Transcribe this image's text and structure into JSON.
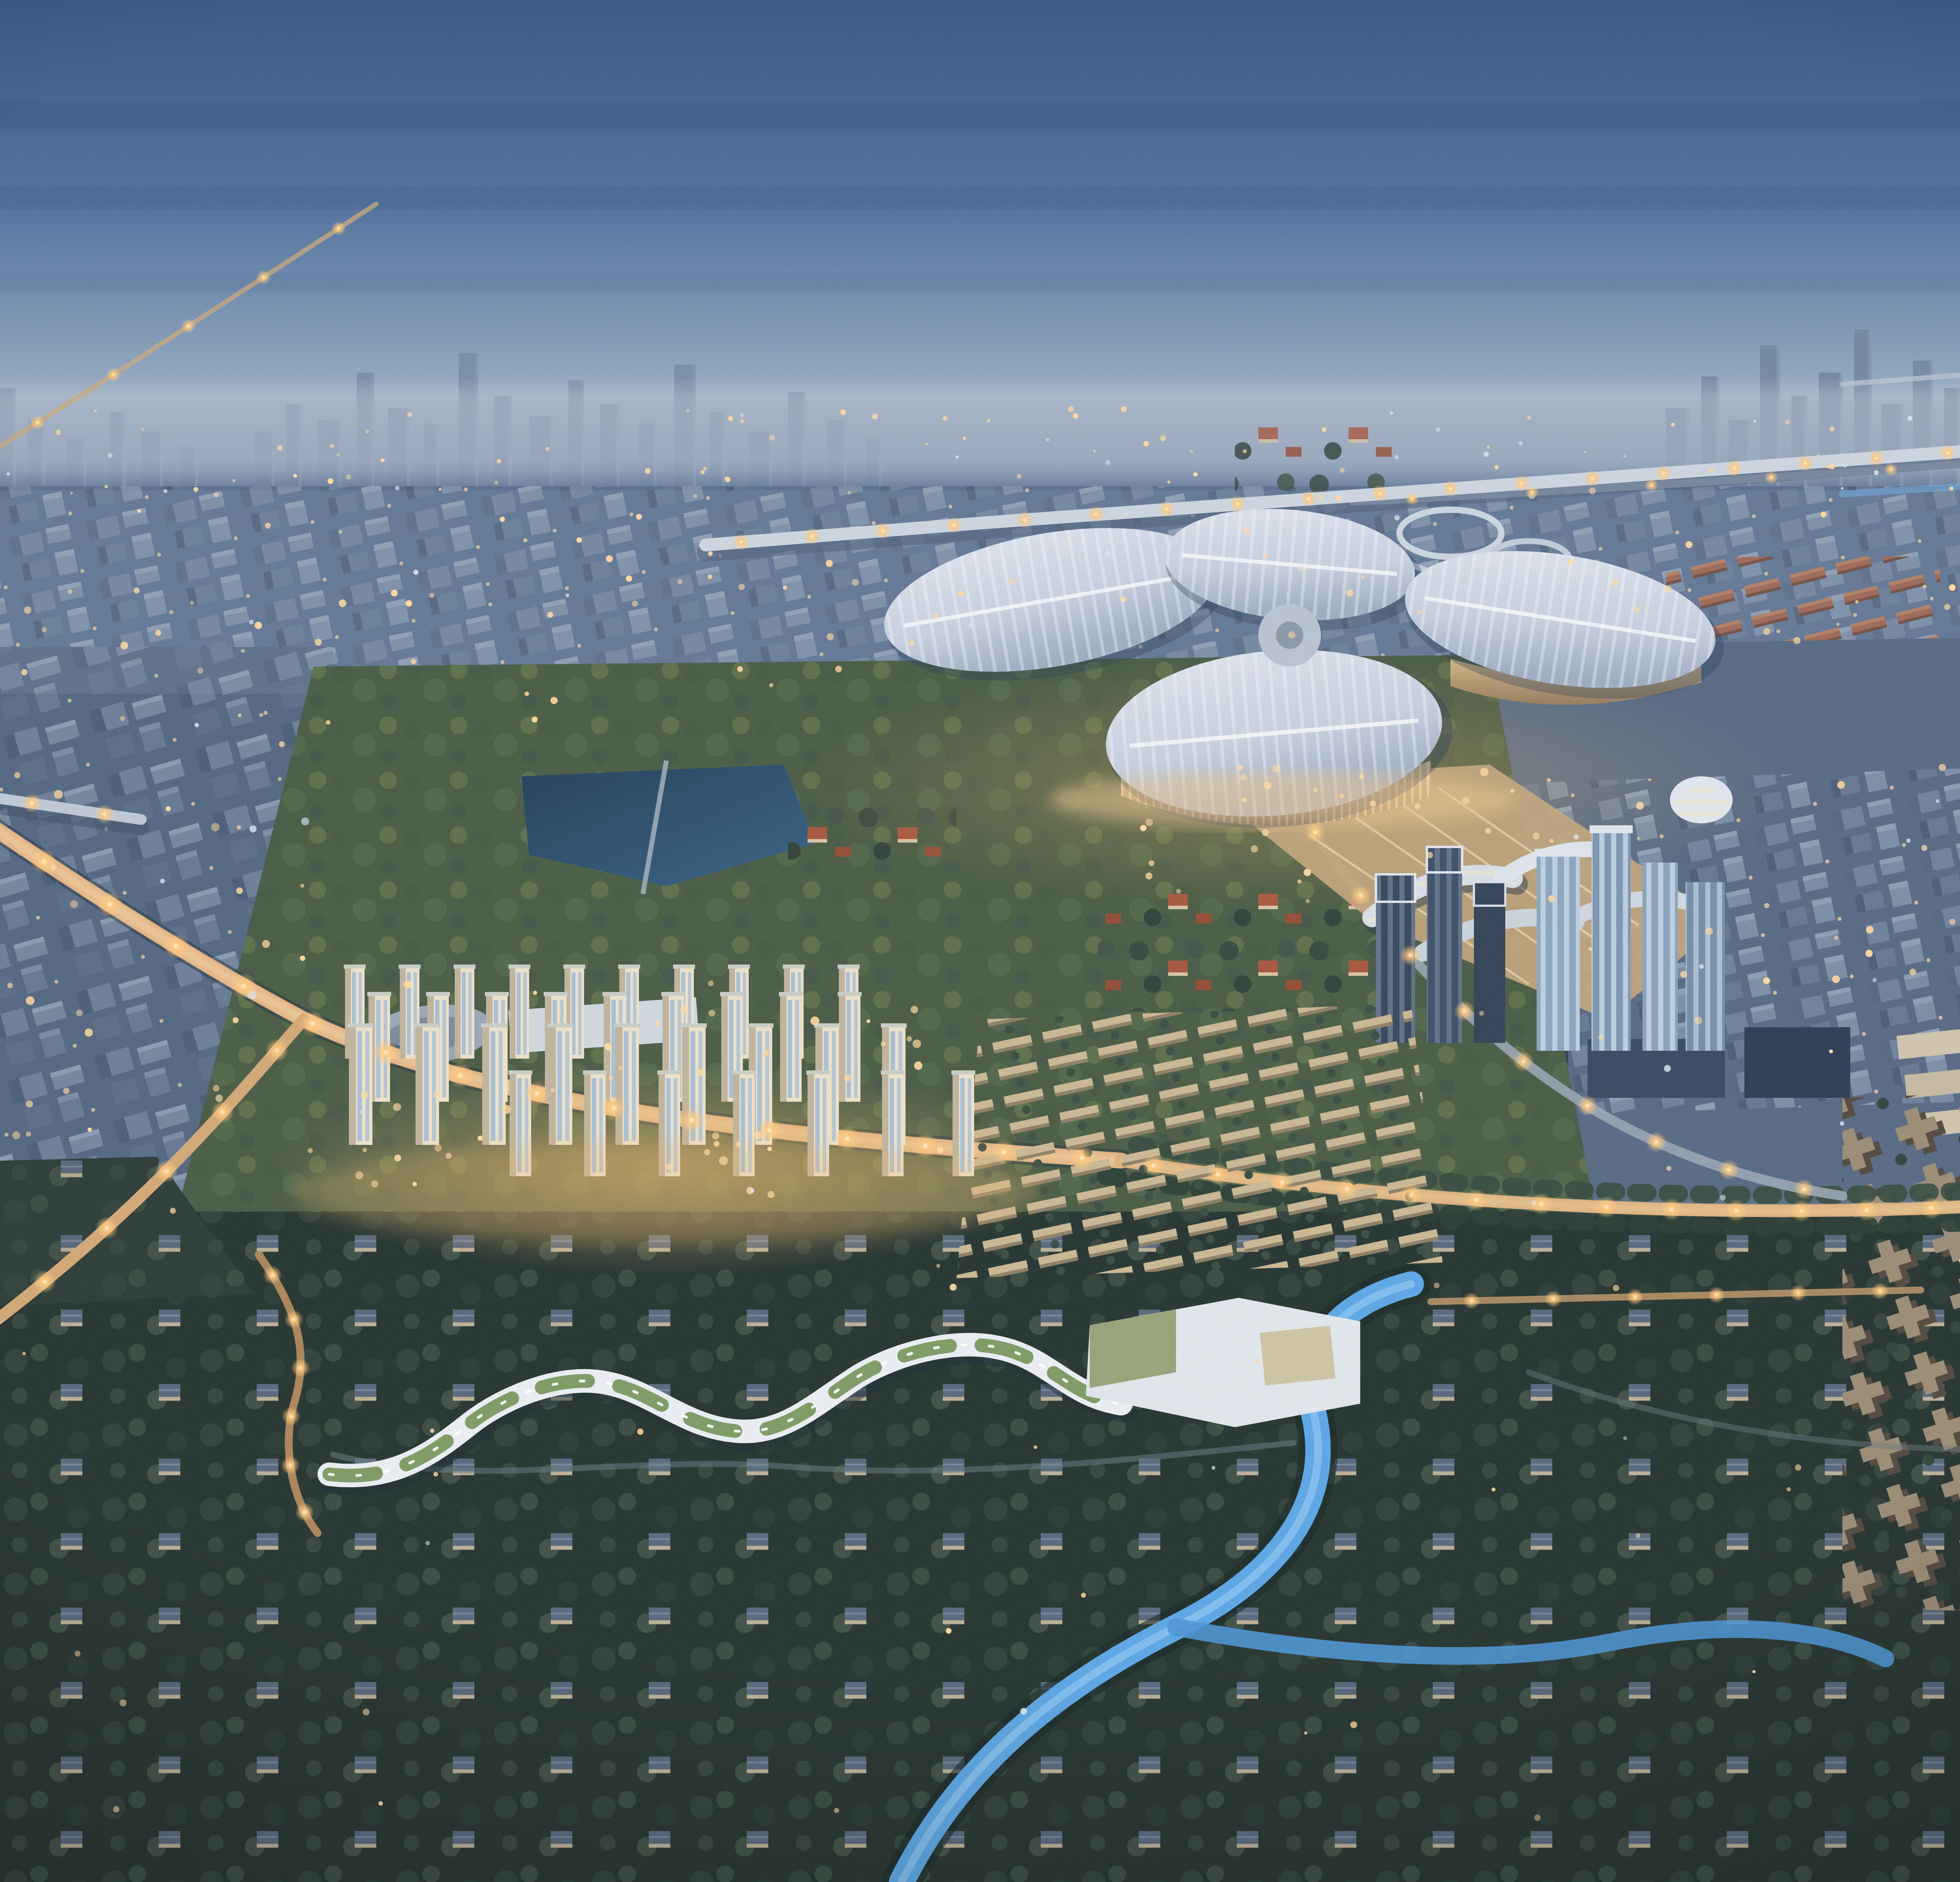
{
  "image": {
    "title": "Dusk aerial rendering of a planned city district",
    "subject": "Bird's-eye architectural visualization at twilight: a four-petal exhibition center beside elevated expressways, a warm-lit residential tower cluster, a serpentine green-roof campus, villa districts threaded with glowing canals, and a hazy high-rise skyline on the horizon",
    "time_of_day": "dusk"
  },
  "palette": {
    "sky_top": "#3a5a86",
    "sky_mid": "#52729d",
    "sky_low": "#8fa7bc00",
    "sky_lower": "#8ea4bc",
    "horizon_haze": "#bcc6d1",
    "far_silhouette": "#71849f",
    "city_base": "#5d7090",
    "city_block_hi": "#8294aa",
    "city_block_lo": "#4b5e77",
    "atmosphere": "#93a5bb",
    "window_warm": "#ffd9a0",
    "window_cool": "#d6e4f0",
    "glow_core": "#fff3d2",
    "glow_warm": "#ffc97e",
    "road_lit": "#dfb082",
    "road_grey": "#8e9aa9",
    "expressway": "#ccd4de",
    "clover_roof": "#dde3ec",
    "clover_shadow": "#9fadc1",
    "clover_rib": "#f4f7fa",
    "facade_warm": "#e7c491",
    "plaza": "#c2a67e",
    "resi_wall": "#ece0c9",
    "resi_glass": "#a9bfd4",
    "resi_shadow": "#c0b49d",
    "school_white": "#e9edf2",
    "school_green": "#7f9c66",
    "tree_dark": "#2e3d38",
    "tree_mid": "#3e5045",
    "tree_light": "#56644c",
    "tree_gold": "#8f835a",
    "grass_park": "#4d5e48",
    "forest": "#2a3834",
    "water": "#5ea7e4",
    "water_light": "#9cd0f4",
    "water_deep": "#2f6ea6",
    "lake_dark": "#27425c",
    "lake_lit": "#3c6486",
    "villa_roof": "#5e6d82",
    "villa_wall": "#c3b69c",
    "orange_roof": "#a85940",
    "tan_block": "#c9b795",
    "cream_slab": "#cfc4ae",
    "dark_office": "#32435a",
    "glass_tower": "#8ea6bd",
    "lattice_tower": "#3a4a5e",
    "tower_cap": "#dfe5ec"
  },
  "skyline": {
    "clusters": [
      {
        "name": "left-distant-towers",
        "base": 252,
        "opacity": 0.72,
        "towers": [
          [
            44,
            10,
            34
          ],
          [
            60,
            8,
            46
          ],
          [
            74,
            12,
            30
          ],
          [
            96,
            9,
            52
          ],
          [
            112,
            11,
            38
          ],
          [
            130,
            8,
            28
          ],
          [
            150,
            10,
            58
          ],
          [
            166,
            9,
            40
          ],
          [
            182,
            12,
            32
          ],
          [
            204,
            8,
            48
          ],
          [
            220,
            10,
            36
          ],
          [
            240,
            9,
            26
          ],
          [
            258,
            11,
            44
          ],
          [
            276,
            8,
            30
          ],
          [
            296,
            12,
            54
          ],
          [
            314,
            9,
            38
          ],
          [
            334,
            10,
            28
          ],
          [
            356,
            8,
            42
          ],
          [
            372,
            11,
            32
          ],
          [
            392,
            9,
            24
          ]
        ]
      },
      {
        "name": "center-distant-towers",
        "base": 250,
        "opacity": 0.66,
        "towers": [
          [
            430,
            10,
            30
          ],
          [
            446,
            8,
            44
          ],
          [
            462,
            12,
            36
          ],
          [
            482,
            9,
            60
          ],
          [
            498,
            11,
            42
          ],
          [
            516,
            8,
            34
          ],
          [
            534,
            10,
            70
          ],
          [
            552,
            9,
            48
          ],
          [
            570,
            12,
            38
          ],
          [
            590,
            8,
            56
          ],
          [
            606,
            10,
            44
          ],
          [
            626,
            9,
            34
          ],
          [
            644,
            11,
            64
          ],
          [
            662,
            8,
            40
          ],
          [
            682,
            12,
            30
          ],
          [
            702,
            9,
            50
          ],
          [
            722,
            10,
            36
          ],
          [
            742,
            8,
            26
          ]
        ]
      },
      {
        "name": "right-cbd-towers",
        "base": 264,
        "opacity": 0.82,
        "towers": [
          [
            1150,
            12,
            56
          ],
          [
            1168,
            9,
            72
          ],
          [
            1182,
            11,
            50
          ],
          [
            1198,
            10,
            88
          ],
          [
            1214,
            8,
            62
          ],
          [
            1228,
            12,
            74
          ],
          [
            1246,
            9,
            96
          ],
          [
            1260,
            11,
            58
          ],
          [
            1276,
            10,
            80
          ],
          [
            1292,
            8,
            66
          ],
          [
            1306,
            12,
            104
          ],
          [
            1324,
            9,
            70
          ],
          [
            1338,
            11,
            86
          ],
          [
            1356,
            10,
            60
          ],
          [
            1372,
            8,
            92
          ],
          [
            1386,
            12,
            74
          ],
          [
            1404,
            9,
            58
          ],
          [
            1420,
            11,
            80
          ],
          [
            1438,
            10,
            64
          ],
          [
            1454,
            8,
            72
          ],
          [
            1470,
            12,
            52
          ],
          [
            1488,
            9,
            66
          ],
          [
            1504,
            11,
            48
          ],
          [
            1522,
            10,
            58
          ],
          [
            1540,
            8,
            44
          ],
          [
            1556,
            10,
            36
          ]
        ]
      }
    ]
  },
  "residential": {
    "rows": [
      {
        "base": 540,
        "h": 46,
        "w": 10,
        "x": [
          476,
          504,
          532,
          560,
          588,
          616,
          644,
          672,
          700,
          728
        ]
      },
      {
        "base": 562,
        "h": 54,
        "w": 11,
        "x": [
          488,
          518,
          548,
          578,
          608,
          638,
          668,
          698,
          728
        ]
      },
      {
        "base": 584,
        "h": 60,
        "w": 12,
        "x": [
          478,
          512,
          546,
          580,
          614,
          648,
          682,
          716,
          750
        ]
      },
      {
        "base": 600,
        "h": 52,
        "w": 11,
        "x": [
          560,
          598,
          636,
          674,
          712,
          750,
          786
        ]
      }
    ]
  },
  "lights": {
    "roads": [
      {
        "path": "p-blvd-far",
        "count": 9,
        "r": 1.7
      },
      {
        "path": "p-blvd",
        "count": 20,
        "r": 3.0
      },
      {
        "path": "p-right-ave",
        "count": 22,
        "r": 2.6
      },
      {
        "path": "p-west-exit",
        "count": 13,
        "r": 2.7
      },
      {
        "path": "p-south-loop",
        "count": 6,
        "r": 2.2
      },
      {
        "path": "p-expwy",
        "count": 26,
        "r": 2.0
      },
      {
        "path": "p-expwy2",
        "count": 10,
        "r": 1.6
      },
      {
        "path": "p-left-viaduct",
        "count": 10,
        "r": 2.3
      },
      {
        "path": "p-plaza-road",
        "count": 9,
        "r": 2.4
      },
      {
        "path": "p-right-road",
        "count": 7,
        "r": 2.2
      },
      {
        "path": "p-far-street",
        "count": 7,
        "r": 1.5
      },
      {
        "path": "p-ave-lower",
        "count": 6,
        "r": 2.0
      }
    ],
    "scatter": [
      {
        "x": 0,
        "y": 208,
        "w": 1600,
        "h": 46,
        "count": 130,
        "r": 1.1,
        "warm": 0.8
      },
      {
        "x": 0,
        "y": 260,
        "w": 740,
        "h": 120,
        "count": 80,
        "r": 1.5,
        "warm": 0.85
      },
      {
        "x": 0,
        "y": 380,
        "w": 460,
        "h": 250,
        "count": 70,
        "r": 1.7,
        "warm": 0.85
      },
      {
        "x": 760,
        "y": 250,
        "w": 840,
        "h": 80,
        "count": 55,
        "r": 1.4,
        "warm": 0.85
      },
      {
        "x": 1040,
        "y": 390,
        "w": 560,
        "h": 240,
        "count": 70,
        "r": 1.5,
        "warm": 0.8
      },
      {
        "x": 470,
        "y": 500,
        "w": 340,
        "h": 110,
        "count": 45,
        "r": 1.7,
        "warm": 0.95
      },
      {
        "x": 880,
        "y": 390,
        "w": 260,
        "h": 70,
        "count": 30,
        "r": 1.6,
        "warm": 0.95
      },
      {
        "x": 0,
        "y": 640,
        "w": 1600,
        "h": 300,
        "count": 45,
        "r": 1.4,
        "warm": 0.9
      },
      {
        "x": 1300,
        "y": 300,
        "w": 300,
        "h": 70,
        "count": 25,
        "r": 1.5,
        "warm": 0.9
      }
    ]
  },
  "regions": [
    {
      "id": "exhibition-center",
      "label": "four-petal exhibition hall"
    },
    {
      "id": "residential-cluster",
      "label": "warm-lit residential towers"
    },
    {
      "id": "serpentine-school",
      "label": "green-roof terraced campus"
    },
    {
      "id": "villa-district",
      "label": "low-rise villa neighborhoods"
    },
    {
      "id": "expressway",
      "label": "elevated expressway and interchange"
    },
    {
      "id": "distant-skyline",
      "label": "hazy high-rise skyline"
    },
    {
      "id": "canals",
      "label": "glowing canals and ponds"
    }
  ]
}
